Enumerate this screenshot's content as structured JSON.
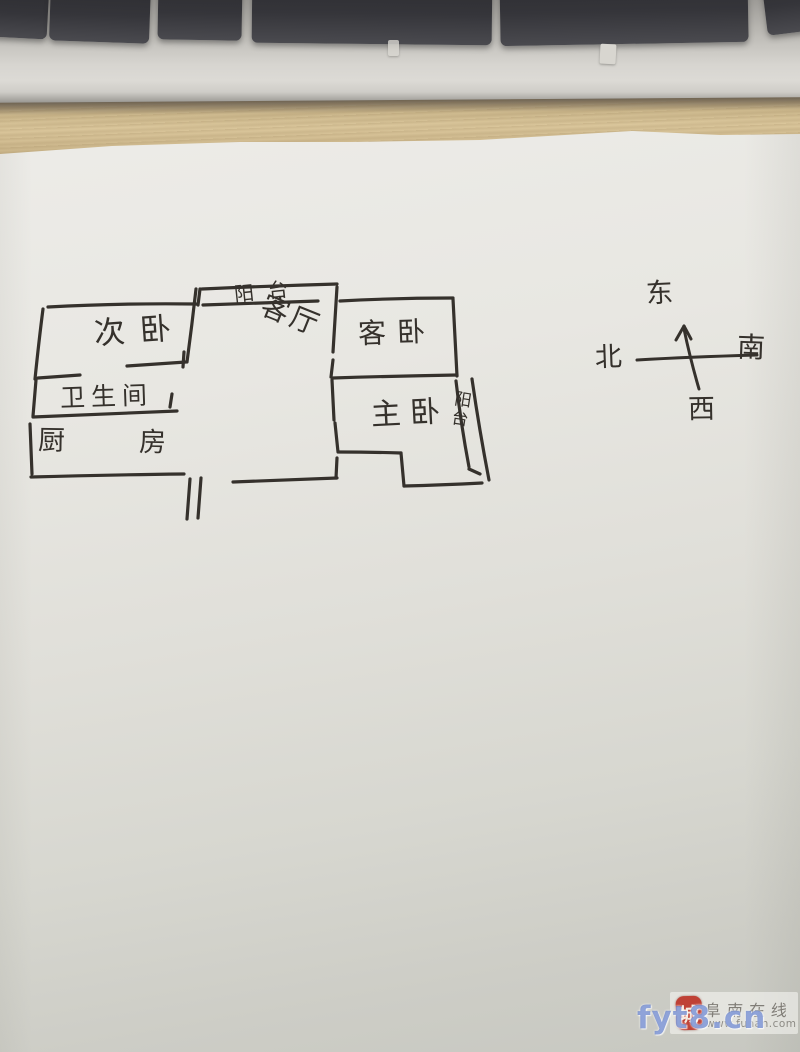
{
  "floorplan": {
    "rooms": [
      {
        "key": "secondary_bedroom",
        "label": "次卧"
      },
      {
        "key": "balcony_top",
        "label": "阳台"
      },
      {
        "key": "living_room",
        "label": "客厅"
      },
      {
        "key": "guest_bedroom",
        "label": "客卧"
      },
      {
        "key": "master_bedroom",
        "label": "主卧"
      },
      {
        "key": "balcony_right",
        "label": "阳台"
      },
      {
        "key": "bathroom",
        "label": "卫生间"
      },
      {
        "key": "kitchen",
        "label": "厨房"
      }
    ]
  },
  "compass": {
    "up": "东",
    "left": "北",
    "right": "南",
    "down": "西"
  },
  "watermark": {
    "seal_text": "城",
    "site_name": "阜南在线",
    "site_url": "www.funan.com",
    "overlay_text": "fyt8.cn"
  },
  "colors": {
    "ink": "#35312c",
    "paper": "#e7e6e1",
    "wood": "#d5c197",
    "keycap": "#323236",
    "seal_red": "#bf4136",
    "overlay_blue": "#4a6ac2",
    "watermark_gray": "#807d77"
  }
}
